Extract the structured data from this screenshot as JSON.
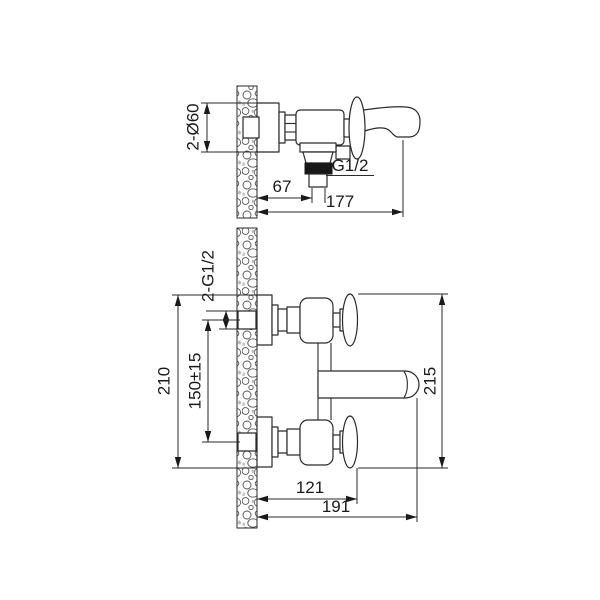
{
  "drawing": {
    "title": "bath-mixer-installation-dimensions",
    "background_color": "#ffffff",
    "line_color": "#2a2a2a",
    "thread_color": "#181818",
    "side_view": {
      "dims": {
        "escutcheon_diameter": "2-Ø60",
        "wall_to_outlet": "67",
        "wall_to_spout_end": "177"
      },
      "labels": {
        "outlet_thread": "G1/2"
      }
    },
    "plan_view": {
      "dims": {
        "connection_thread": "2-G1/2",
        "overall_height": "210",
        "connection_spacing": "150±15",
        "body_span": "215",
        "wall_to_handles": "121",
        "wall_to_spout_tip": "191"
      }
    }
  }
}
